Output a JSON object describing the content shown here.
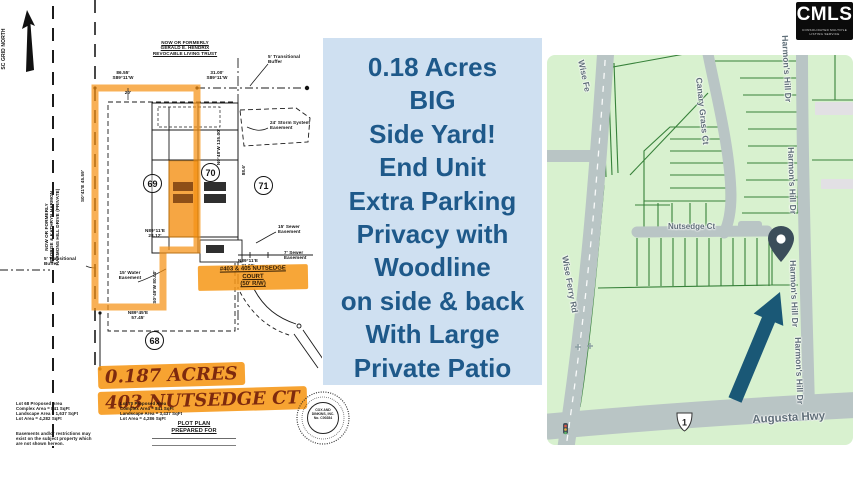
{
  "logo": {
    "name": "CMLS",
    "tagline": "CONSOLIDATED MULTIPLE LISTING SERVICE"
  },
  "callout": {
    "lines": [
      "0.18 Acres",
      "BIG",
      "Side Yard!",
      "End Unit",
      "Extra Parking",
      "Privacy with",
      "Woodline",
      "on side & back",
      "With Large",
      "Private Patio"
    ],
    "bg_color": "#cfe0f1",
    "text_color": "#1e598a"
  },
  "plot": {
    "north": "SC GRID NORTH",
    "owner_top": "NOW OR FORMERLY\nGERALD E. HENDRIX\nREVOCABLE LIVING TRUST",
    "owner_left": "NOW OR FORMERLY\nGEORGE & KATHRYN HARMON\nHARMONS HILL DRIVE (PRIVATE)",
    "dim_86": "86.55'\nS89°11'W",
    "dim_31": "31.00'\nS89°11'W",
    "dim_20": "20'",
    "dim_2812": "N89°11'E\n28.12'",
    "dim_3100": "N89°11'E\n31.00'",
    "dim_5745": "N89°45'E\n57.45'",
    "dim_left_v": "S0°41'E 45.59'",
    "dim_right_v": "N0°48'W 135.00'",
    "dim_886": "88.6'",
    "dim_80": "S0°49'W 80.00'",
    "buffer_note": "5' Transitional\nBuffer",
    "buffer_note2": "5' Transitional\nBuffer",
    "storm_note": "24' Storm System\nEasement",
    "sewer15_note": "15' Sewer\nEasement",
    "sewer7_note": "7' Sewer\nEasement",
    "water15_note": "15' Water\nEasement",
    "lot68": "68",
    "lot69": "69",
    "lot70": "70",
    "lot71": "71",
    "street_hl": "#403 & 405 NUTSEDGE\nCOURT\n(50' R/W)",
    "hand1": "0.187 ACRES",
    "hand2": "403 NUTSEDGE CT",
    "notes_left": "Lot 68 Proposed Area\nComplex Area = 841 SqFt\nLandscape Area = 1,637 SqFt\nLot Area = 4,282 SqFt",
    "notes_right": "Lot 70 Proposed Area\nComplex Area = 841 SqFt\nLandscape Area = 3,437 SqFt\nLot Area = 4,286 SqFt",
    "disclaimer": "Easements and/or restrictions may\nexist on the subject property which\nare not shown hereon.",
    "prepared": "PLOT PLAN\nPREPARED FOR",
    "seal_inner": "COX AND\nDINKINS, INC.\nNo. C00284",
    "highlight_color": "#f59115"
  },
  "map": {
    "roads": {
      "wise_top": "Wise Fe",
      "wise": "Wise Ferry Rd",
      "canary": "Canary Grass Ct",
      "nutsedge": "Nutsedge Ct",
      "harmons": "Harmon's Hill Dr",
      "augusta": "Augusta Hwy",
      "route": "1"
    },
    "colors": {
      "bg": "#d8f1cf",
      "parcel_line": "#37813a",
      "road": "#b9c5c5",
      "label": "#5f6e78",
      "pin": "#3b4d5a",
      "arrow": "#1a5876"
    }
  }
}
